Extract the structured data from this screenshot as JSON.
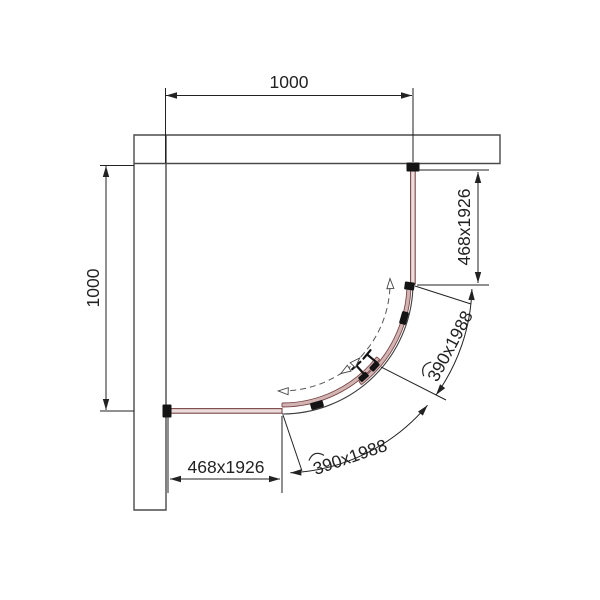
{
  "drawing": {
    "title": "quadrant-shower-enclosure-plan"
  },
  "dimensions": {
    "width_top": "1000",
    "height_left": "1000",
    "fixed_panel_right": "468x1926",
    "fixed_panel_bottom": "468x1926",
    "sliding_door_right": "390x1988",
    "sliding_door_bottom": "390x1988"
  },
  "colors": {
    "background": "#ffffff",
    "wall": "#4a4a4a",
    "dimension": "#222222",
    "track": "#3c3c3c",
    "glass_fill": "#d3b4b4",
    "glass_fill_light": "#ecdcdc",
    "glass_edge": "#7a4545",
    "hardware": "#141414"
  }
}
